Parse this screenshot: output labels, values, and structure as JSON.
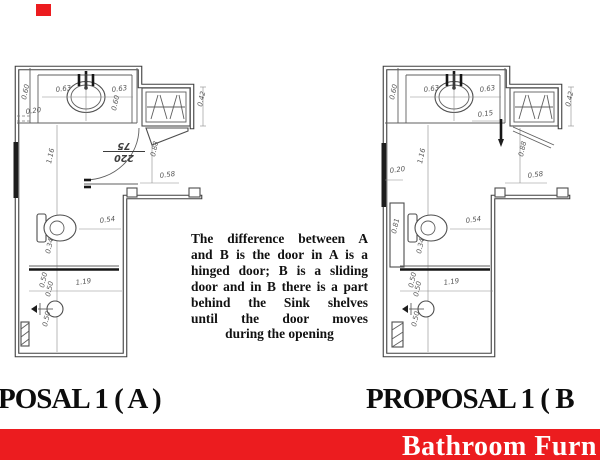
{
  "colors": {
    "accent": "#ec1c1f",
    "wall": "#3f3f3f",
    "dim_text": "#565656"
  },
  "corner_mark": {
    "name": "red-corner-mark"
  },
  "titles": {
    "left": "POSAL 1 ( A )",
    "right": "PROPOSAL 1 ( B"
  },
  "footer": {
    "brand": "Bathroom Furn"
  },
  "description": {
    "lines": [
      "The difference between A",
      "and B is the door in A is a",
      "hinged door; B is a sliding",
      "door and in B there is a part",
      "behind the Sink shelves",
      "until the door moves",
      "during the opening"
    ]
  },
  "plans": {
    "a": {
      "name": "proposal-a-floor-plan",
      "door_tag": {
        "top": "220",
        "bottom": "75"
      },
      "labels": [
        {
          "t": "0.60",
          "x": 26,
          "y": 100,
          "r": -78
        },
        {
          "t": "0.63",
          "x": 56,
          "y": 92,
          "r": -8
        },
        {
          "t": "0.63",
          "x": 112,
          "y": 92,
          "r": -8
        },
        {
          "t": "0.60",
          "x": 116,
          "y": 111,
          "r": -78
        },
        {
          "t": "0.20",
          "x": 26,
          "y": 114,
          "r": -8
        },
        {
          "t": "0.42",
          "x": 202,
          "y": 107,
          "r": -78
        },
        {
          "t": "1.16",
          "x": 51,
          "y": 164,
          "r": -78
        },
        {
          "t": "0.88",
          "x": 155,
          "y": 157,
          "r": -78
        },
        {
          "t": "0.58",
          "x": 160,
          "y": 178,
          "r": -8
        },
        {
          "t": "0.54",
          "x": 100,
          "y": 223,
          "r": -8
        },
        {
          "t": "0.34",
          "x": 50,
          "y": 254,
          "r": -78
        },
        {
          "t": "1.19",
          "x": 76,
          "y": 285,
          "r": -8
        },
        {
          "t": "0.50",
          "x": 44,
          "y": 288,
          "r": -78
        },
        {
          "t": "0.50",
          "x": 50,
          "y": 297,
          "r": -78
        },
        {
          "t": "0.50",
          "x": 47,
          "y": 327,
          "r": -78
        }
      ]
    },
    "b": {
      "name": "proposal-b-floor-plan",
      "labels": [
        {
          "t": "0.60",
          "x": 394,
          "y": 100,
          "r": -78
        },
        {
          "t": "0.63",
          "x": 424,
          "y": 92,
          "r": -8
        },
        {
          "t": "0.63",
          "x": 480,
          "y": 92,
          "r": -8
        },
        {
          "t": "0.15",
          "x": 478,
          "y": 117,
          "r": -8
        },
        {
          "t": "0.42",
          "x": 570,
          "y": 107,
          "r": -78
        },
        {
          "t": "1.16",
          "x": 422,
          "y": 164,
          "r": -78
        },
        {
          "t": "0.88",
          "x": 523,
          "y": 157,
          "r": -78
        },
        {
          "t": "0.58",
          "x": 528,
          "y": 178,
          "r": -8
        },
        {
          "t": "0.20",
          "x": 390,
          "y": 173,
          "r": -8
        },
        {
          "t": "0.81",
          "x": 396,
          "y": 234,
          "r": -78
        },
        {
          "t": "0.54",
          "x": 466,
          "y": 223,
          "r": -8
        },
        {
          "t": "0.34",
          "x": 421,
          "y": 254,
          "r": -78
        },
        {
          "t": "1.19",
          "x": 444,
          "y": 285,
          "r": -8
        },
        {
          "t": "0.50",
          "x": 413,
          "y": 288,
          "r": -78
        },
        {
          "t": "0.50",
          "x": 418,
          "y": 297,
          "r": -78
        },
        {
          "t": "0.50",
          "x": 416,
          "y": 327,
          "r": -78
        }
      ]
    }
  }
}
